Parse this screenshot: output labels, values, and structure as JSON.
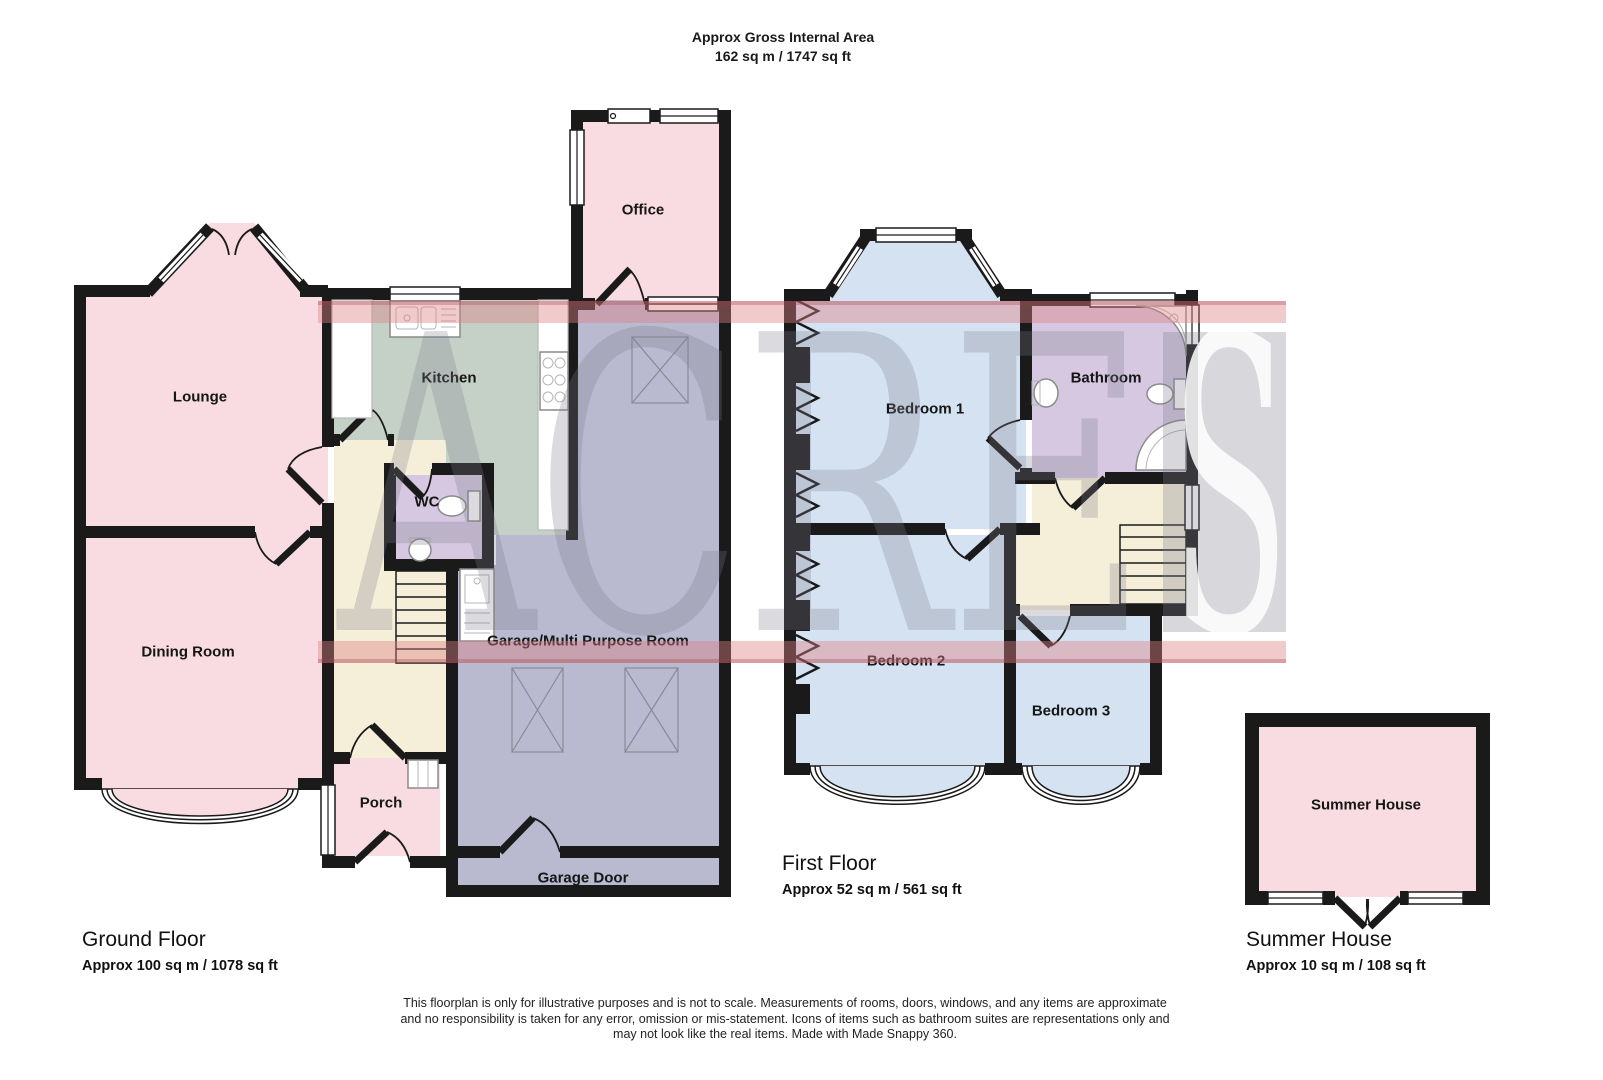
{
  "header": {
    "line1": "Approx Gross Internal Area",
    "line2": "162 sq m / 1747 sq ft"
  },
  "watermark": {
    "text_left": "ACRE",
    "text_right": "S"
  },
  "floors": {
    "ground": {
      "name": "Ground Floor",
      "area": "Approx 100 sq m / 1078 sq ft",
      "rooms": {
        "lounge": "Lounge",
        "dining": "Dining Room",
        "kitchen": "Kitchen",
        "wc": "WC",
        "porch": "Porch",
        "office": "Office",
        "garage": "Garage/Multi Purpose Room",
        "garage_door": "Garage Door"
      }
    },
    "first": {
      "name": "First Floor",
      "area": "Approx 52 sq m / 561 sq ft",
      "rooms": {
        "bedroom1": "Bedroom 1",
        "bedroom2": "Bedroom 2",
        "bedroom3": "Bedroom 3",
        "bathroom": "Bathroom"
      }
    },
    "summer": {
      "name": "Summer House",
      "area": "Approx 10 sq m / 108 sq ft",
      "rooms": {
        "summer_house": "Summer House"
      }
    }
  },
  "disclaimer": {
    "line1": "This floorplan is only for illustrative purposes and is not to scale. Measurements of rooms, doors, windows, and any items are approximate",
    "line2": "and no responsibility is taken for any error, omission or mis-statement. Icons of items such as bathroom suites are representations only and",
    "line3": "may not look like the real items. Made with Made Snappy 360."
  },
  "colors": {
    "room-pink": "#f8dce2",
    "kitchen-green": "#c5d1c6",
    "wc-lavender": "#d6c8e0",
    "hall-cream": "#f5eed8",
    "garage-purple": "#b9b9d0",
    "bedroom-blue": "#d4e2f1",
    "wall": "#1a1a1a",
    "watermark-red": "rgba(222,128,134,0.42)",
    "watermark-gray": "rgba(125,125,140,0.28)"
  }
}
